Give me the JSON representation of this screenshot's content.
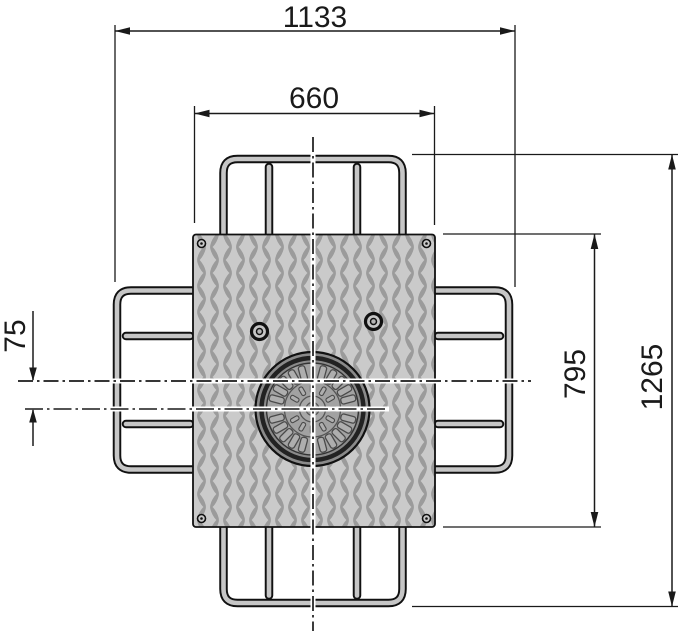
{
  "drawing": {
    "kind": "technical-drawing-plan-view",
    "dimensions": {
      "overall_width": "1133",
      "cover_plate_width": "660",
      "center_offset": "75",
      "cover_plate_depth": "795",
      "overall_depth": "1265"
    },
    "colors": {
      "line": "#1a1a1a",
      "plate_fill": "#cacaca",
      "plate_pattern": "#9b9b9b",
      "tube_fill": "#c6c6c6",
      "cover_ring": "#8a8a8a",
      "cover_face": "#a2a2a2",
      "cover_slot_fill": "#aeaeae",
      "cover_slot_line": "#4a4a4a",
      "background": "#ffffff"
    }
  }
}
